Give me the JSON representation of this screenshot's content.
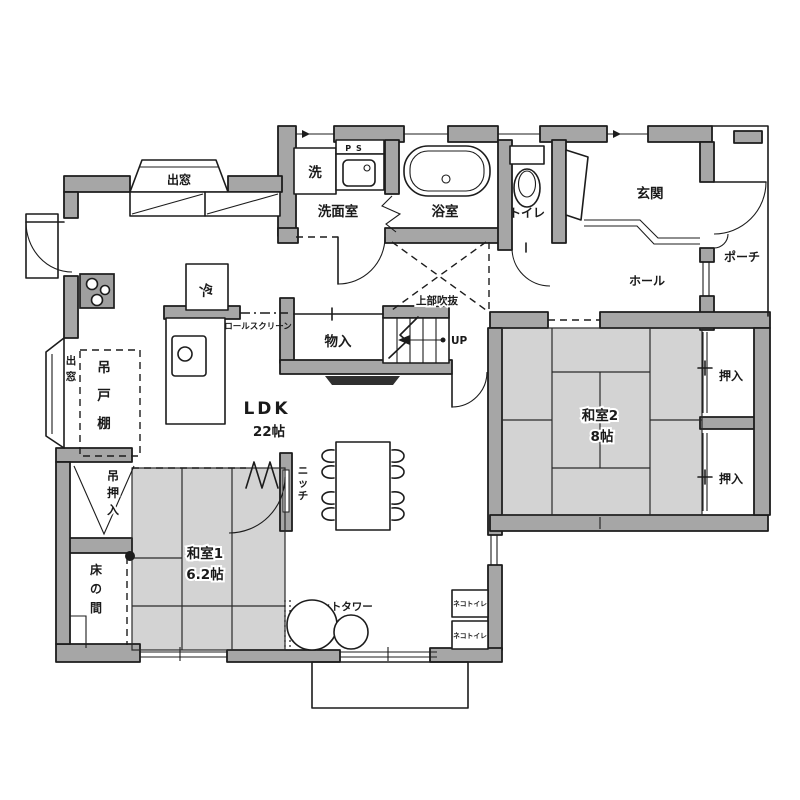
{
  "plan": {
    "title": "間取り図",
    "colors": {
      "wall": "#a6a6a6",
      "tatami": "#d3d3d3",
      "line": "#1c1c1c",
      "background": "#ffffff"
    },
    "rooms": {
      "senmen": {
        "label": "洗面室"
      },
      "bath": {
        "label": "浴室"
      },
      "toilet": {
        "label": "トイレ"
      },
      "genkan": {
        "label": "玄関"
      },
      "porch": {
        "label": "ポーチ"
      },
      "hall": {
        "label": "ホール"
      },
      "ldk": {
        "label": "LDK",
        "size": "22帖"
      },
      "washitsu1": {
        "label": "和室1",
        "size": "6.2帖"
      },
      "washitsu2": {
        "label": "和室2",
        "size": "8帖"
      },
      "tokonoma": {
        "label": "床の間"
      },
      "monoire": {
        "label": "物入"
      },
      "oshiire_upper": {
        "label": "押入"
      },
      "oshiire_lower": {
        "label": "押入"
      }
    },
    "features": {
      "bay_window_top": "出窓",
      "bay_window_left": "出窓",
      "hanging_cabinet": "吊戸棚",
      "hanging_closet": "吊押入",
      "roll_screen": "ロールスクリーン",
      "niche": "ニッチ",
      "void_above": "上部吹抜",
      "stairs_up": "UP",
      "fridge": "冷",
      "washer": "洗",
      "pipe_space": "PS",
      "cat_tower": "キャットタワー",
      "cat_toilet_1": "ネコトイレ",
      "cat_toilet_2": "ネコトイレ"
    }
  }
}
